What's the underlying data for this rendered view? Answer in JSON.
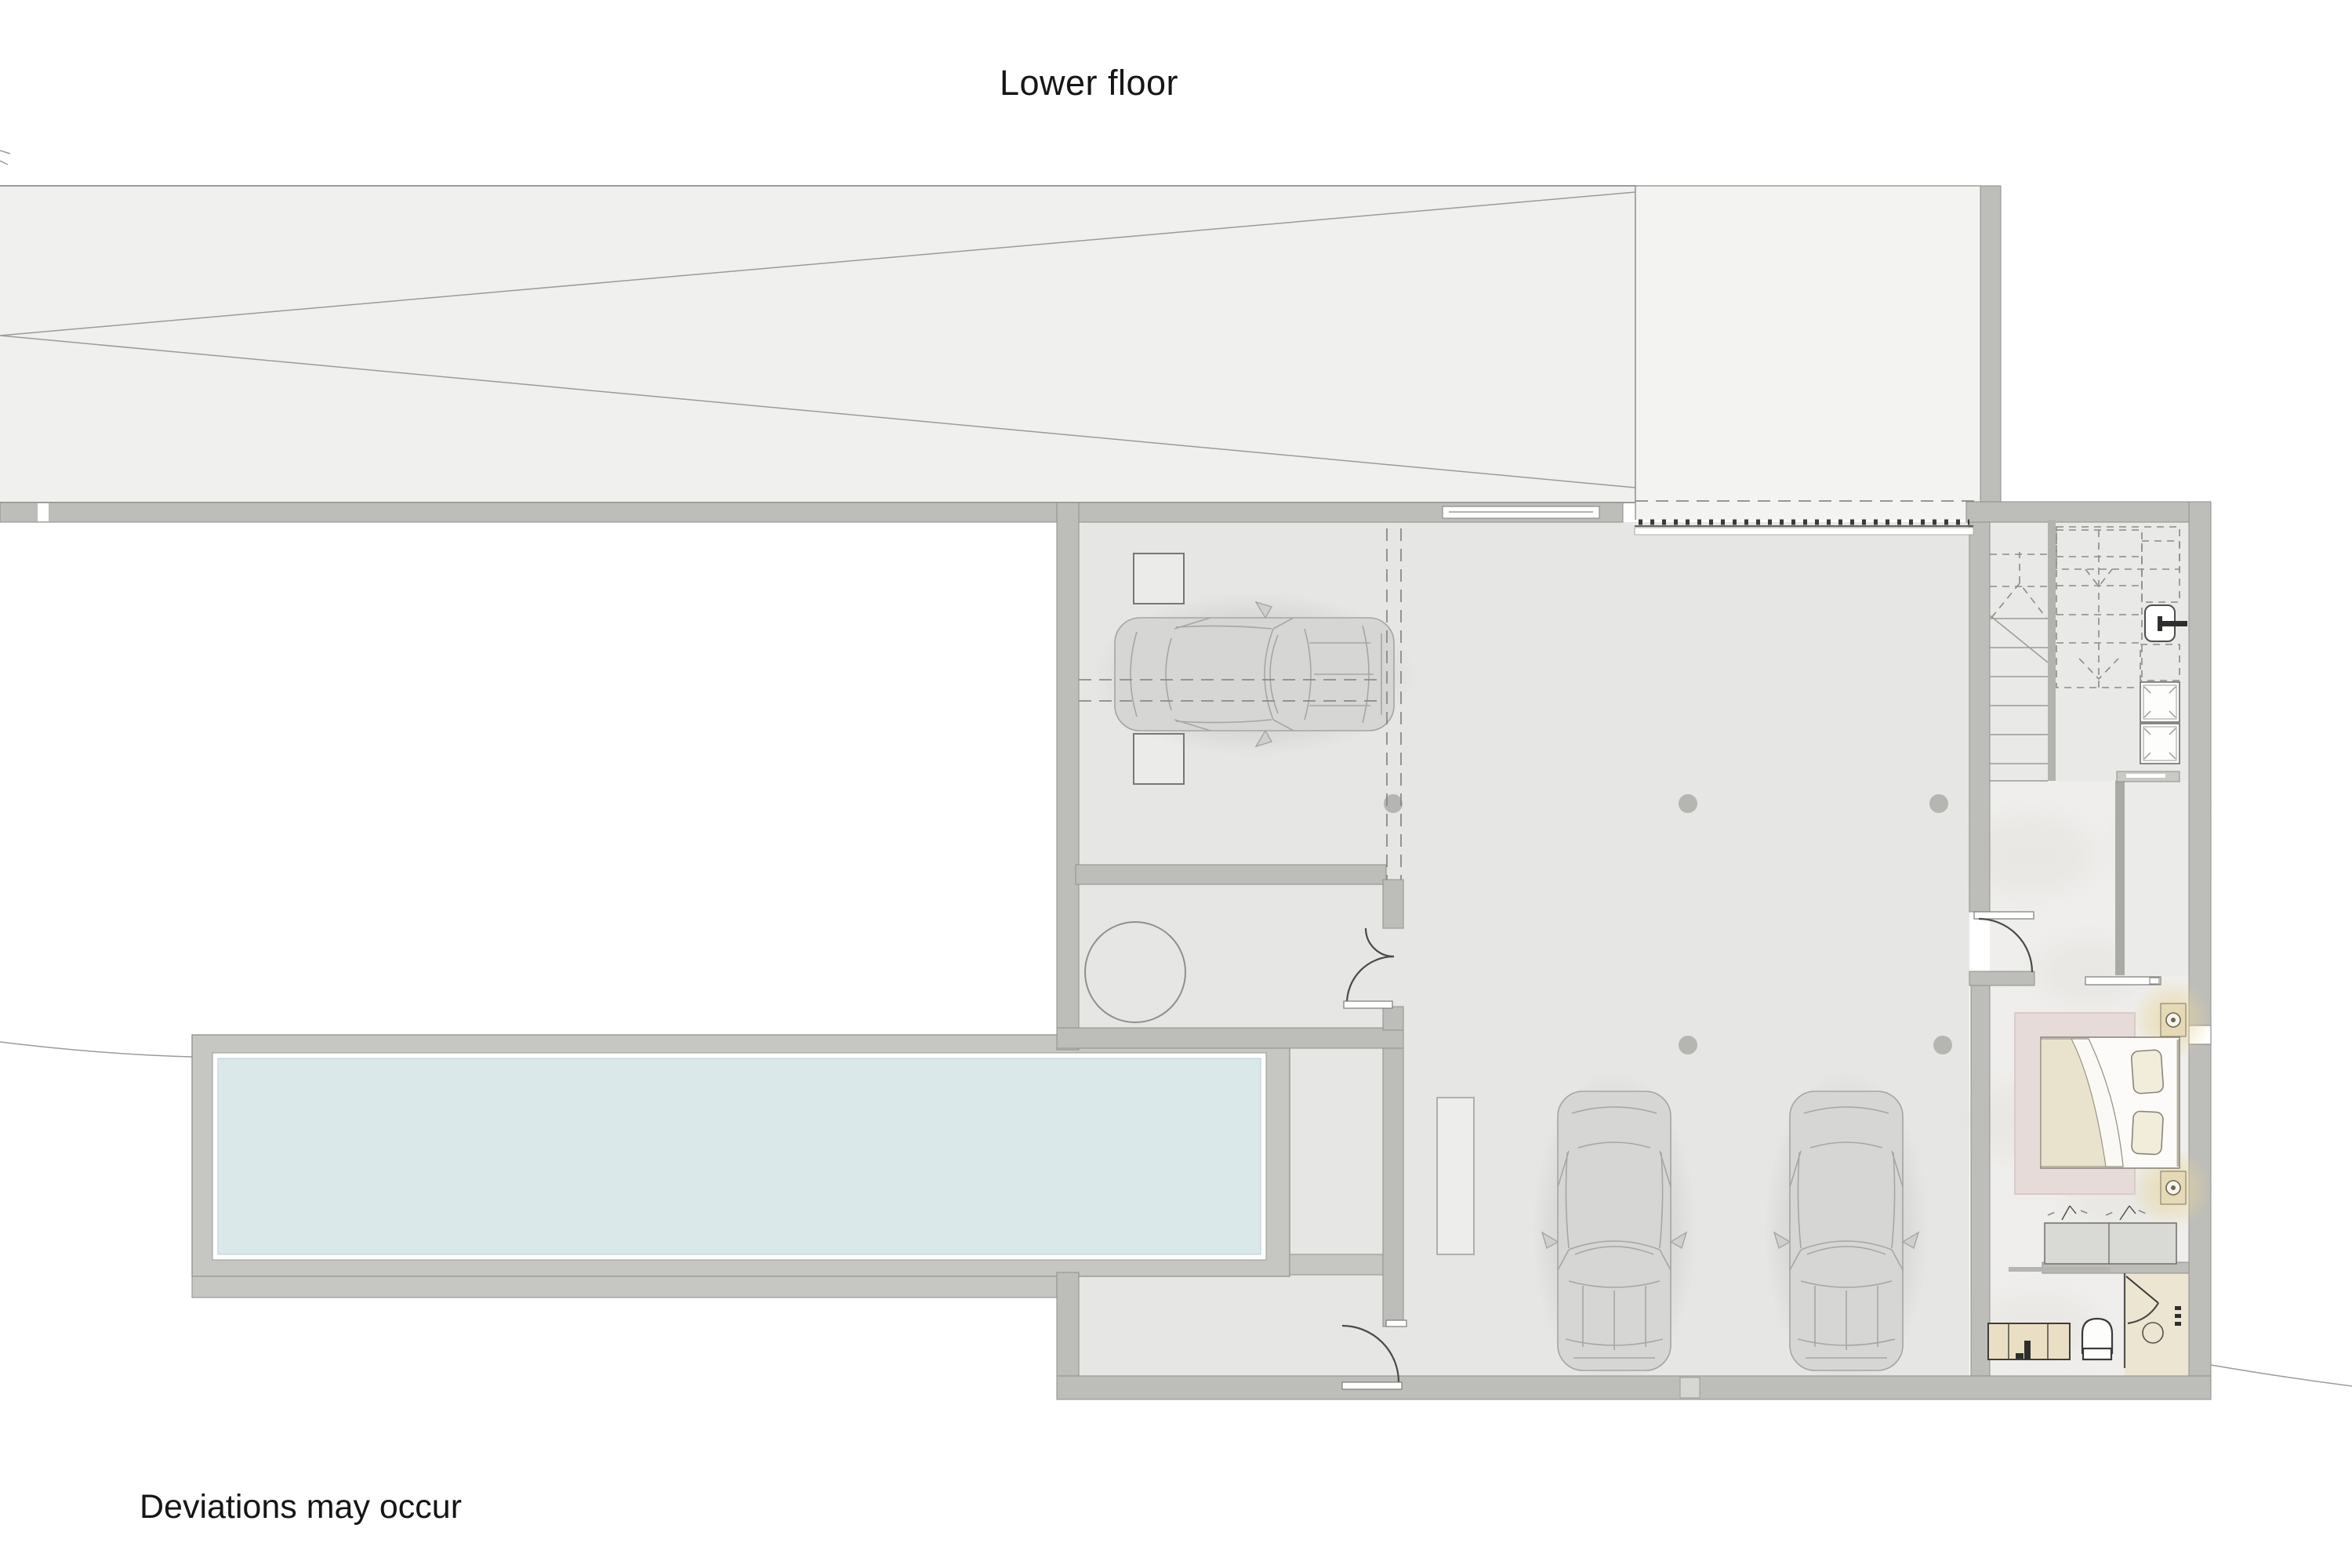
{
  "labels": {
    "title": "Lower floor",
    "disclaimer": "Deviations may occur"
  },
  "palette": {
    "wall": "#bdbdb9",
    "wallDark": "#a9a9a5",
    "line": "#8e8e8b",
    "ink": "#161616",
    "floor": "#e6e6e5",
    "floorRight": "#e9e9e7",
    "marble": "#efeeec",
    "ramp": "#f0f0ee",
    "rampLight": "#f3f3f1",
    "deck": "#c6c6c3",
    "water": "#dae8ea",
    "rug": "#e7dbd9",
    "duvet": "#e9e2cc",
    "beige": "#e6dab6",
    "cream": "#ece5d2"
  }
}
